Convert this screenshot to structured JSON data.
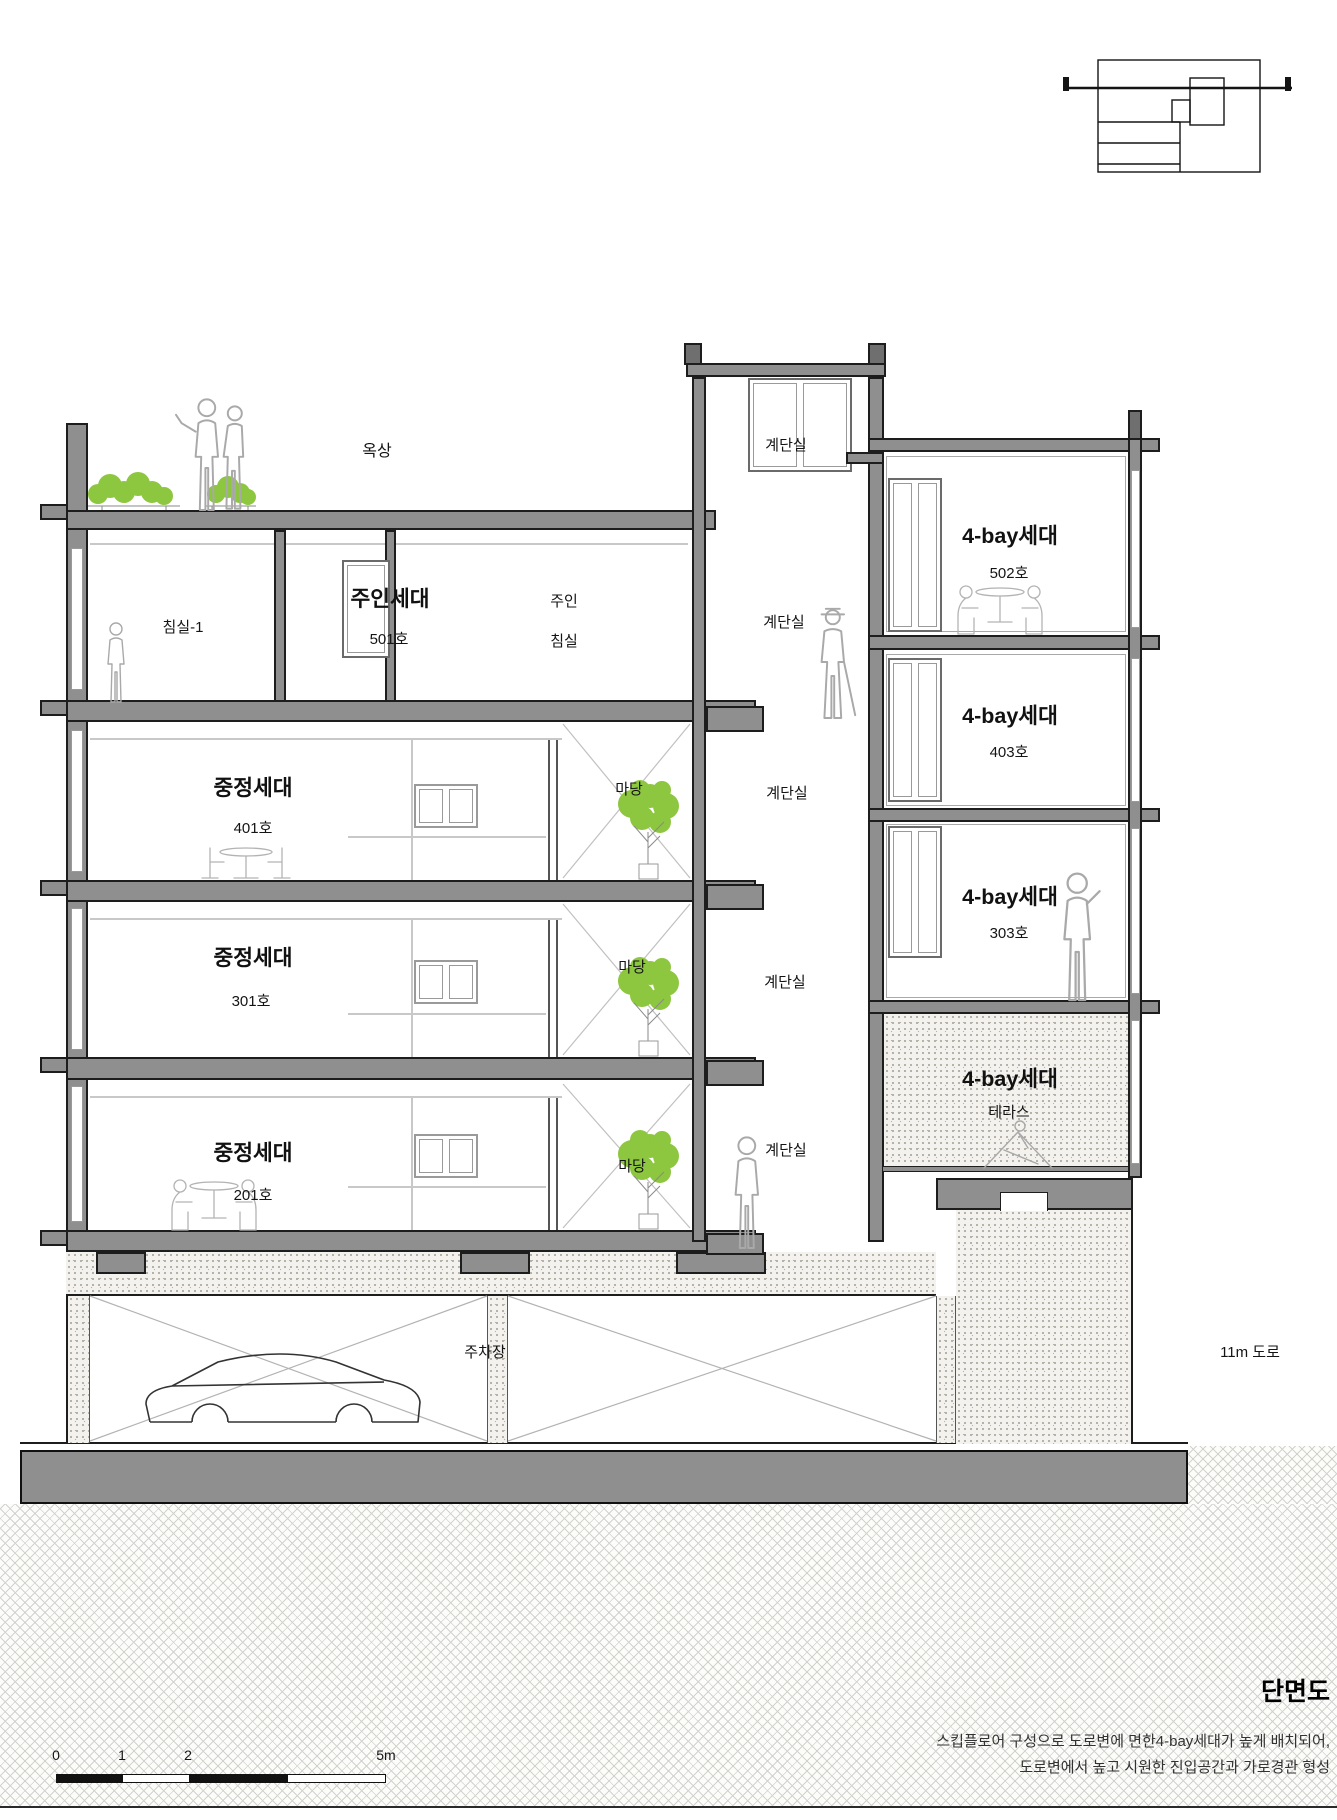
{
  "labels": {
    "roof": "옥상",
    "bedroom1": "침실-1",
    "owner_unit": "주인세대",
    "unit_501": "501호",
    "owner": "주인",
    "bedroom": "침실",
    "stair": "계단실",
    "courtyard_unit": "중정세대",
    "unit_401": "401호",
    "unit_301": "301호",
    "unit_201": "201호",
    "courtyard": "마당",
    "fourbay_unit": "4-bay세대",
    "unit_502": "502호",
    "unit_403": "403호",
    "unit_303": "303호",
    "terrace": "테라스",
    "parking": "주차장",
    "road": "11m 도로"
  },
  "title_block": {
    "title": "단면도",
    "description_line1": "스킵플로어 구성으로 도로변에 면한4-bay세대가 높게 배치되어,",
    "description_line2": "도로변에서 높고 시원한 진입공간과 가로경관 형성"
  },
  "scale_bar": {
    "tick_0": "0",
    "tick_1": "1",
    "tick_2": "2",
    "tick_5": "5m"
  },
  "colors": {
    "structure_gray": "#8f8f8f",
    "line_black": "#1d1d1d",
    "foliage_green": "#8dc63f",
    "figure_gray": "#a9a9a9"
  }
}
